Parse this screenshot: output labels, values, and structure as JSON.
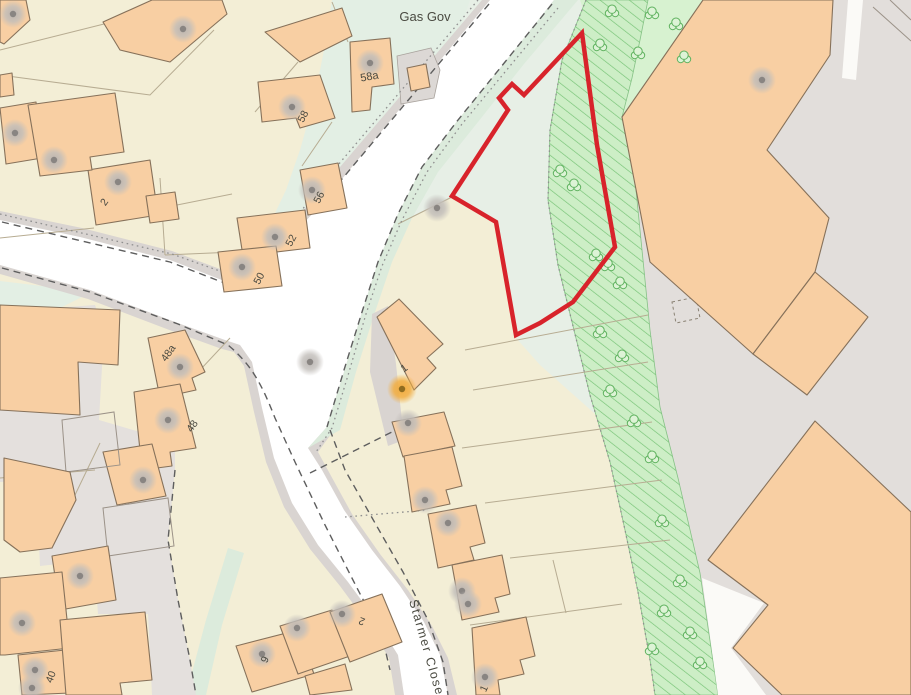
{
  "map": {
    "type": "site-location-plan",
    "colors": {
      "cream": "#f3eed6",
      "gray1": "#e4e0dd",
      "gray2": "#e2dedb",
      "roadWhite": "#ffffff",
      "casing": "#d9d4d1",
      "vergeGreen": "#dcebdc",
      "siteGreen": "#e7efe6",
      "stripGreen": "#cdeec6",
      "stripHatch": "#74c274",
      "stripEdge": "#86c286",
      "lightGreen": "#d7f2d0",
      "treeLine": "#5fb25f",
      "treeFill": "#ddf3d6",
      "building": "#f8cfa3",
      "buildingLine": "#86715a",
      "parcelLine": "#b7ac92",
      "dashLine": "#5e5e5e",
      "dotLine": "#8f8f8f",
      "red": "#d8232b",
      "grayDotOuter": "#c0bcb9",
      "grayDotInner": "#898582",
      "amberOuter": "#f2a93c",
      "amberInner": "#8f6c20",
      "labelColor": "#4a4a41"
    },
    "site_boundary": {
      "points": "582,33 524,95 512,84 499,98 508,110 452,196 496,222 516,335 540,323 573,302 615,247 597,145",
      "stroke_width": 4.5
    },
    "labels": [
      {
        "text": "Gas Gov",
        "x": 425,
        "y": 21,
        "rot": 0,
        "size": 13,
        "anchor": "middle"
      },
      {
        "text": "58a",
        "x": 370,
        "y": 80,
        "rot": -10,
        "size": 11,
        "anchor": "middle"
      },
      {
        "text": "58",
        "x": 306,
        "y": 118,
        "rot": -62,
        "size": 10.5,
        "anchor": "middle"
      },
      {
        "text": "56",
        "x": 322,
        "y": 199,
        "rot": -62,
        "size": 10.5,
        "anchor": "middle"
      },
      {
        "text": "52",
        "x": 294,
        "y": 242,
        "rot": -62,
        "size": 10.5,
        "anchor": "middle"
      },
      {
        "text": "50",
        "x": 262,
        "y": 280,
        "rot": -62,
        "size": 10.5,
        "ananchor": "middle",
        "anchor": "middle"
      },
      {
        "text": "2",
        "x": 107,
        "y": 204,
        "rot": -55,
        "size": 10.5,
        "anchor": "middle"
      },
      {
        "text": "48a",
        "x": 171,
        "y": 355,
        "rot": -55,
        "size": 10.5,
        "anchor": "middle"
      },
      {
        "text": "48",
        "x": 195,
        "y": 428,
        "rot": -55,
        "size": 10.5,
        "anchor": "middle"
      },
      {
        "text": "40",
        "x": 54,
        "y": 678,
        "rot": -70,
        "size": 10.5,
        "anchor": "middle"
      },
      {
        "text": "9",
        "x": 268,
        "y": 661,
        "rot": -65,
        "size": 10.5,
        "anchor": "middle"
      },
      {
        "text": "2",
        "x": 363,
        "y": 618,
        "rot": 200,
        "size": 10.5,
        "anchor": "middle"
      },
      {
        "text": "1",
        "x": 406,
        "y": 371,
        "rot": -35,
        "size": 10.5,
        "anchor": "middle"
      },
      {
        "text": "1",
        "x": 487,
        "y": 690,
        "rot": -65,
        "size": 10.5,
        "anchor": "middle"
      },
      {
        "text": "Starmer Close",
        "x": 409,
        "y": 601,
        "rot": 74,
        "size": 12.5,
        "anchor": "start",
        "spacing": 1.5
      }
    ],
    "symbols": {
      "amber_dot": {
        "x": 402,
        "y": 389
      },
      "gray_dots": [
        [
          13,
          14
        ],
        [
          183,
          29
        ],
        [
          370,
          63
        ],
        [
          292,
          107
        ],
        [
          15,
          133
        ],
        [
          54,
          160
        ],
        [
          118,
          182
        ],
        [
          312,
          190
        ],
        [
          275,
          237
        ],
        [
          242,
          267
        ],
        [
          437,
          208
        ],
        [
          310,
          362
        ],
        [
          762,
          80
        ],
        [
          408,
          423
        ],
        [
          425,
          500
        ],
        [
          448,
          523
        ],
        [
          462,
          591
        ],
        [
          468,
          604
        ],
        [
          485,
          677
        ],
        [
          180,
          367
        ],
        [
          168,
          420
        ],
        [
          143,
          480
        ],
        [
          80,
          576
        ],
        [
          22,
          623
        ],
        [
          35,
          670
        ],
        [
          32,
          688
        ],
        [
          262,
          654
        ],
        [
          297,
          628
        ],
        [
          342,
          614
        ]
      ],
      "trees": [
        [
          612,
          12
        ],
        [
          652,
          14
        ],
        [
          676,
          25
        ],
        [
          600,
          46
        ],
        [
          638,
          54
        ],
        [
          684,
          58
        ],
        [
          560,
          172
        ],
        [
          574,
          186
        ],
        [
          596,
          256
        ],
        [
          608,
          266
        ],
        [
          620,
          284
        ],
        [
          600,
          333
        ],
        [
          622,
          357
        ],
        [
          610,
          392
        ],
        [
          634,
          422
        ],
        [
          652,
          458
        ],
        [
          662,
          522
        ],
        [
          680,
          582
        ],
        [
          664,
          612
        ],
        [
          690,
          634
        ],
        [
          700,
          664
        ],
        [
          652,
          650
        ]
      ]
    }
  }
}
